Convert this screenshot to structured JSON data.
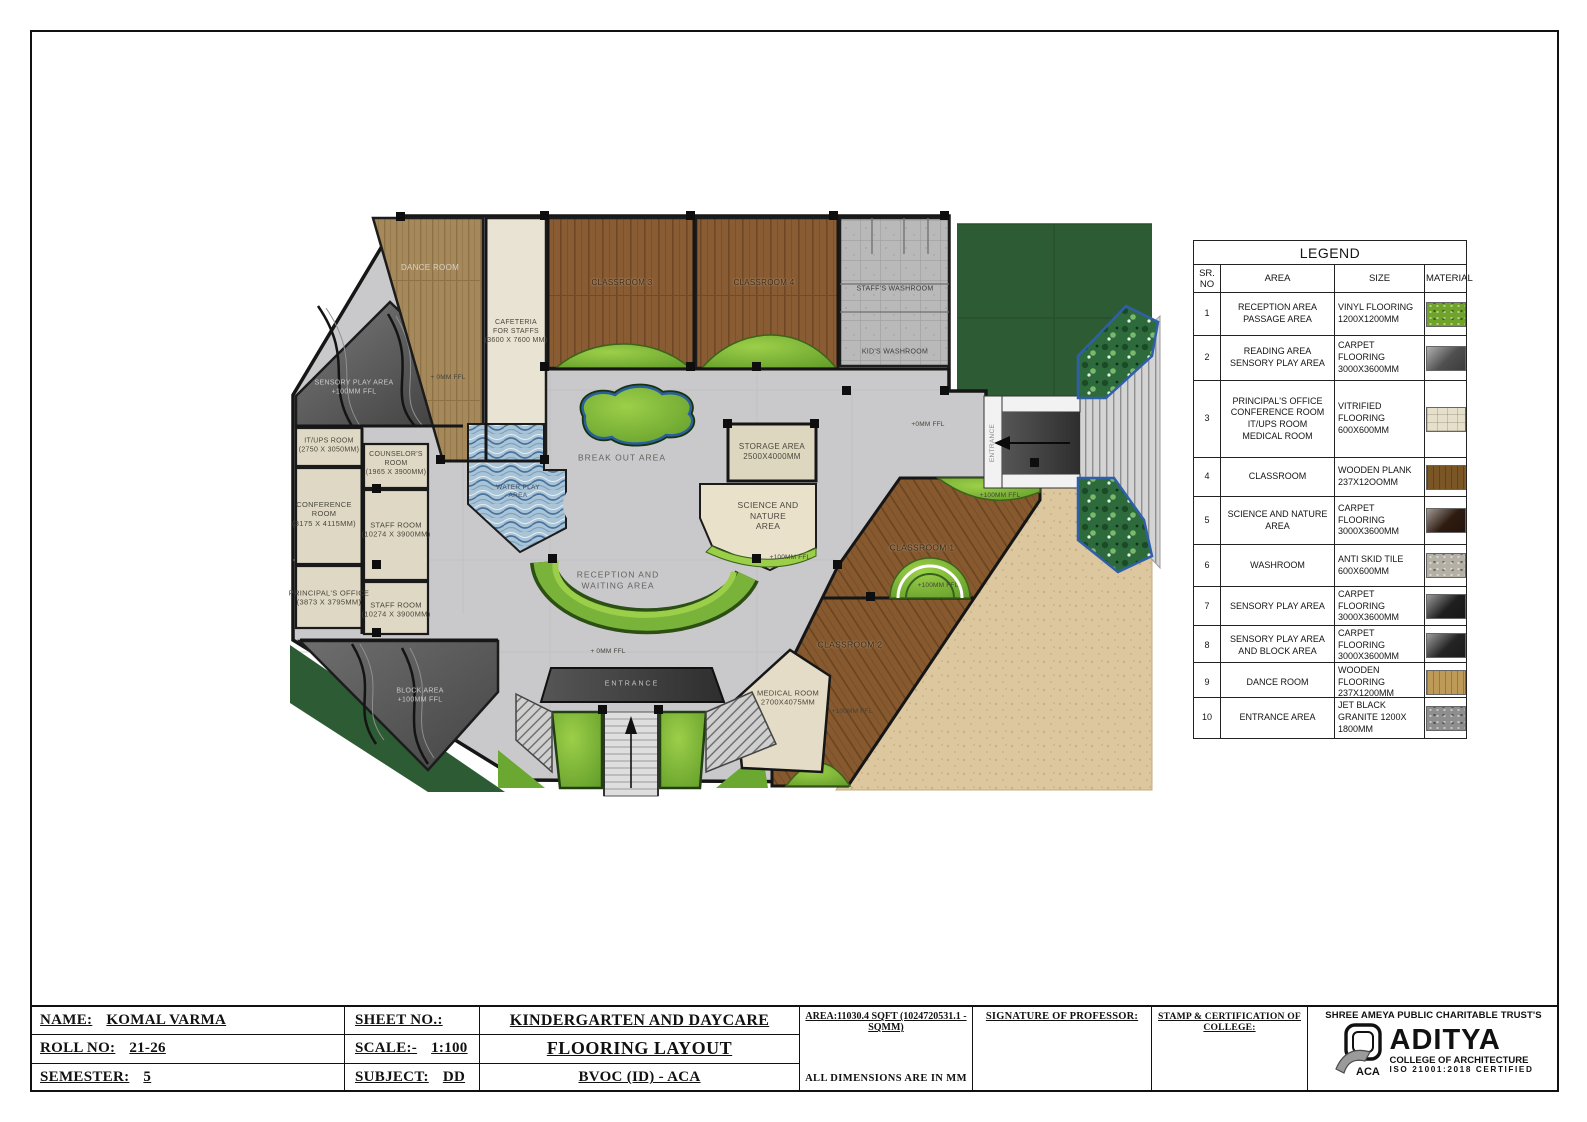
{
  "plan": {
    "labels": {
      "dance_room": "DANCE ROOM",
      "cafeteria": "CAFETERIA\nFOR STAFFS\n(3600 X 7600 MM)",
      "classroom3": "CLASSROOM 3",
      "classroom4": "CLASSROOM 4",
      "staffs_washroom": "STAFF'S WASHROOM",
      "kids_washroom": "KID'S WASHROOM",
      "sensory_play": "SENSORY PLAY AREA\n+100MM FFL",
      "itups": "IT/UPS ROOM\n(2750 X 3050MM)",
      "counselors": "COUNSELOR'S\nROOM\n(1965 X 3900MM)",
      "conference": "CONFERENCE\nROOM\n(3175 X 4115MM)",
      "staff_room_1": "STAFF ROOM\n(10274 X 3900MM)",
      "principals_office": "PRINCIPAL'S OFFICE\n(3873 X 3795MM)",
      "staff_room_2": "STAFF ROOM\n(10274 X 3900MM)",
      "break_out": "BREAK OUT AREA",
      "storage": "STORAGE AREA\n2500X4000MM",
      "science_nature": "SCIENCE AND\nNATURE\nAREA",
      "reception": "RECEPTION AND\nWAITING AREA",
      "water_play": "WATER PLAY\nAREA",
      "block_area": "BLOCK AREA\n+100MM FFL",
      "classroom1": "CLASSROOM 1",
      "classroom2": "CLASSROOM 2",
      "medical": "MEDICAL ROOM\n2700X4075MM",
      "entrance_bottom": "ENTRANCE",
      "entrance_right": "ENTRANCE",
      "ffl_0_top": "+ 0MM FFL",
      "ffl_0_right": "+0MM FFL",
      "ffl_0_bottom": "+ 0MM FFL",
      "ffl_100_c1": "+100MM FFL",
      "ffl_100_dome": "+100MM FFL",
      "ffl_100_c2": "+100MM FFL",
      "ffl_100_science": "+100MM FFL"
    }
  },
  "legend": {
    "title": "LEGEND",
    "headers": {
      "sr": "SR.\nNO",
      "area": "AREA",
      "size": "SIZE",
      "material": "MATERIAL"
    },
    "rows": [
      {
        "no": "1",
        "area": "RECEPTION AREA\nPASSAGE AREA",
        "size": "VINYL FLOORING\n1200X1200MM",
        "swatch": "#6fa32a"
      },
      {
        "no": "2",
        "area": "READING AREA\nSENSORY PLAY AREA",
        "size": "CARPET FLOORING\n3000X3600MM",
        "swatch": "#4f4f4f"
      },
      {
        "no": "3",
        "area": "PRINCIPAL'S OFFICE\nCONFERENCE ROOM\nIT/UPS ROOM\nMEDICAL ROOM",
        "size": "VITRIFIED\nFLOORING\n600X600MM",
        "swatch": "#e6dfca"
      },
      {
        "no": "4",
        "area": "CLASSROOM",
        "size": "WOODEN PLANK\n237X12OOMM",
        "swatch": "#7a5526"
      },
      {
        "no": "5",
        "area": "SCIENCE AND NATURE\nAREA",
        "size": "CARPET\nFLOORING\n3000X3600MM",
        "swatch": "#2e1b10"
      },
      {
        "no": "6",
        "area": "WASHROOM",
        "size": "ANTI SKID TILE\n600X600MM",
        "swatch": "#b4b0a6"
      },
      {
        "no": "7",
        "area": "SENSORY PLAY AREA",
        "size": "CARPET FLOORING\n3000X3600MM",
        "swatch": "#1f1f1f"
      },
      {
        "no": "8",
        "area": "SENSORY PLAY AREA\nAND BLOCK AREA",
        "size": "CARPET FLOORING\n3000X3600MM",
        "swatch": "#242424"
      },
      {
        "no": "9",
        "area": "DANCE ROOM",
        "size": "WOODEN FLOORING\n237X1200MM",
        "swatch": "#bd9a58"
      },
      {
        "no": "10",
        "area": "ENTRANCE AREA",
        "size": "JET BLACK\nGRANITE 1200X\n1800MM",
        "swatch": "#8e8e8e"
      }
    ]
  },
  "titleblock": {
    "name_label": "NAME:",
    "name_value": "KOMAL VARMA",
    "roll_label": "ROLL NO:",
    "roll_value": "21-26",
    "sem_label": "SEMESTER:",
    "sem_value": "5",
    "sheet_label": "SHEET NO.:",
    "scale_label": "SCALE:-",
    "scale_value": "1:100",
    "subject_label": "SUBJECT:",
    "subject_value": "DD",
    "project_title": "KINDERGARTEN AND DAYCARE",
    "drawing_title": "FLOORING LAYOUT",
    "course": "BVOC (ID) - ACA",
    "area_note": "AREA:11030.4 SQFT (1024720531.1 -SQMM)",
    "dims_note": "ALL DIMENSIONS ARE IN MM",
    "signature_label": "SIGNATURE OF PROFESSOR:",
    "stamp_label": "STAMP & CERTIFICATION OF COLLEGE:",
    "trust": "SHREE AMEYA PUBLIC CHARITABLE TRUST'S",
    "college_name": "ADITYA",
    "college_sub": "COLLEGE OF ARCHITECTURE",
    "college_iso": "ISO 21001:2018 CERTIFIED",
    "logo_acronym": "ACA"
  }
}
